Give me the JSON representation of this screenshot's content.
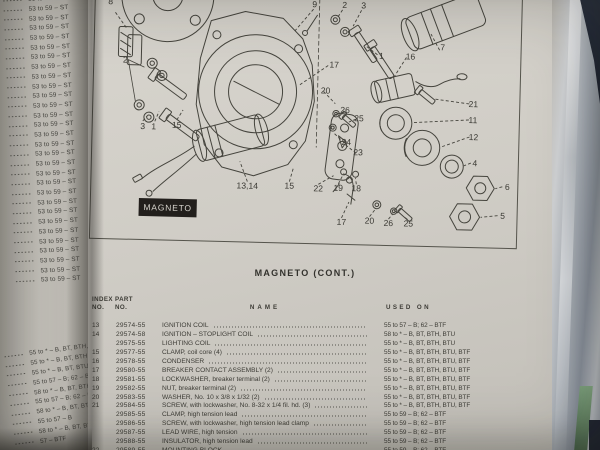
{
  "colors": {
    "paper": "#cdcac3",
    "ink": "#3c3b35",
    "tag_bg": "#221f1c",
    "tag_text": "#d8d5ce",
    "sleeve": "#9aa0a8",
    "cover_navy": "#232a36",
    "cover_green": "#74a173"
  },
  "left_page": {
    "top_lines": [
      "53 to 59 – ST",
      "53 to 59 – ST",
      "53 to 59 – ST",
      "53 to 59 – ST",
      "53 to 59 – ST",
      "53 to 59 – ST",
      "53 to 59 – ST",
      "53 to 59 – ST",
      "53 to 59 – ST",
      "53 to 59 – ST",
      "53 to 59 – ST",
      "53 to 59 – ST",
      "53 to 59 – ST",
      "53 to 59 – ST",
      "53 to 59 – ST",
      "53 to 59 – ST",
      "53 to 59 – ST",
      "53 to 59 – ST",
      "53 to 59 – ST",
      "53 to 59 – ST",
      "53 to 59 – ST",
      "53 to 59 – ST",
      "53 to 59 – ST",
      "53 to 59 – ST",
      "53 to 59 – ST",
      "53 to 59 – ST",
      "53 to 59 – ST",
      "53 to 59 – ST",
      "53 to 59 – ST",
      "53 to 59 – ST"
    ],
    "bottom_lines": [
      "55 to * – B, BT, BTH, BT",
      "55 to * – B, BT, BTH, BT",
      "55 to * – B, BT, BTU",
      "55 to 57 – B; 62 – BTF",
      "58 to * – B, BT, BTH, BT",
      "55 to 57 – B; 62 – BTF",
      "58 to * – B, BT, BTH, BT",
      "55 to 57 – B",
      "58 to * – B, BT, BTH, BT",
      "57 – BTF"
    ]
  },
  "page": {
    "section_label": "MAGNETO",
    "title": "MAGNETO (CONT.)",
    "diagram": {
      "callouts": [
        {
          "n": "8",
          "x": 15,
          "y": 19
        },
        {
          "n": "9",
          "x": 219,
          "y": 17
        },
        {
          "n": "2",
          "x": 249,
          "y": 17
        },
        {
          "n": "3",
          "x": 268,
          "y": 17
        },
        {
          "n": "7",
          "x": 348,
          "y": 57
        },
        {
          "n": "1",
          "x": 287,
          "y": 67
        },
        {
          "n": "16",
          "x": 316,
          "y": 67
        },
        {
          "n": "2",
          "x": 31,
          "y": 77
        },
        {
          "n": "17",
          "x": 240,
          "y": 77
        },
        {
          "n": "20",
          "x": 232,
          "y": 103
        },
        {
          "n": "26",
          "x": 252,
          "y": 122
        },
        {
          "n": "25",
          "x": 266,
          "y": 130
        },
        {
          "n": "21",
          "x": 380,
          "y": 113
        },
        {
          "n": "11",
          "x": 380,
          "y": 129
        },
        {
          "n": "12",
          "x": 381,
          "y": 146
        },
        {
          "n": "24",
          "x": 254,
          "y": 154
        },
        {
          "n": "23",
          "x": 266,
          "y": 164
        },
        {
          "n": "4",
          "x": 383,
          "y": 172
        },
        {
          "n": "6",
          "x": 416,
          "y": 195
        },
        {
          "n": "3",
          "x": 50,
          "y": 143
        },
        {
          "n": "1",
          "x": 61,
          "y": 143
        },
        {
          "n": "15",
          "x": 84,
          "y": 141
        },
        {
          "n": "13,14",
          "x": 156,
          "y": 200
        },
        {
          "n": "15",
          "x": 198,
          "y": 199
        },
        {
          "n": "22",
          "x": 227,
          "y": 201
        },
        {
          "n": "19",
          "x": 247,
          "y": 200
        },
        {
          "n": "18",
          "x": 265,
          "y": 200
        },
        {
          "n": "17",
          "x": 251,
          "y": 234
        },
        {
          "n": "20",
          "x": 279,
          "y": 232
        },
        {
          "n": "26",
          "x": 298,
          "y": 234
        },
        {
          "n": "25",
          "x": 318,
          "y": 234
        },
        {
          "n": "5",
          "x": 412,
          "y": 224
        }
      ]
    },
    "table": {
      "headers": {
        "index": [
          "INDEX",
          "NO."
        ],
        "part": [
          "PART",
          "NO."
        ],
        "name": "NAME",
        "used_on": "USED ON"
      },
      "rows": [
        {
          "index": "13",
          "part": "29574-55",
          "name": "IGNITION COIL",
          "used_on": "55 to 57 – B; 62 – BTF"
        },
        {
          "index": "14",
          "part": "29574-58",
          "name": "IGNITION – STOPLIGHT COIL",
          "used_on": "58 to * – B, BT, BTH, BTU"
        },
        {
          "index": "",
          "part": "29575-55",
          "name": "LIGHTING COIL",
          "used_on": "55 to * – B, BT, BTH, BTU"
        },
        {
          "index": "15",
          "part": "29577-55",
          "name": "CLAMP, coil core (4)",
          "used_on": "55 to * – B, BT, BTH, BTU, BTF"
        },
        {
          "index": "16",
          "part": "29578-55",
          "name": "CONDENSER",
          "used_on": "55 to * – B, BT, BTH, BTU, BTF"
        },
        {
          "index": "17",
          "part": "29580-55",
          "name": "BREAKER CONTACT ASSEMBLY (2)",
          "used_on": "55 to * – B, BT, BTH, BTU, BTF"
        },
        {
          "index": "18",
          "part": "29581-55",
          "name": "LOCKWASHER, breaker terminal (2)",
          "used_on": "55 to * – B, BT, BTH, BTU, BTF"
        },
        {
          "index": "19",
          "part": "29582-55",
          "name": "NUT, breaker terminal (2)",
          "used_on": "55 to * – B, BT, BTH, BTU, BTF"
        },
        {
          "index": "20",
          "part": "29583-55",
          "name": "WASHER, No. 10 x 3/8 x 1/32 (2)",
          "used_on": "55 to * – B, BT, BTH, BTU, BTF"
        },
        {
          "index": "21",
          "part": "29584-55",
          "name": "SCREW, with lockwasher, No. 8-32 x 1/4 fil. hd. (3)",
          "used_on": "55 to * – B, BT, BTH, BTU, BTF"
        },
        {
          "index": "",
          "part": "29585-55",
          "name": "CLAMP, high tension lead",
          "used_on": "55 to 59 – B; 62 – BTF"
        },
        {
          "index": "",
          "part": "29586-55",
          "name": "SCREW, with lockwasher, high tension lead clamp",
          "used_on": "55 to 59 – B; 62 – BTF"
        },
        {
          "index": "",
          "part": "29587-55",
          "name": "LEAD WIRE, high tension",
          "used_on": "55 to 59 – B; 62 – BTF"
        },
        {
          "index": "",
          "part": "29588-55",
          "name": "INSULATOR, high tension lead",
          "used_on": "55 to 59 – B; 62 – BTF"
        },
        {
          "index": "22",
          "part": "29589-55",
          "name": "MOUNTING BLOCK",
          "used_on": "55 to 59 – B; 62 – BTF"
        }
      ]
    }
  }
}
